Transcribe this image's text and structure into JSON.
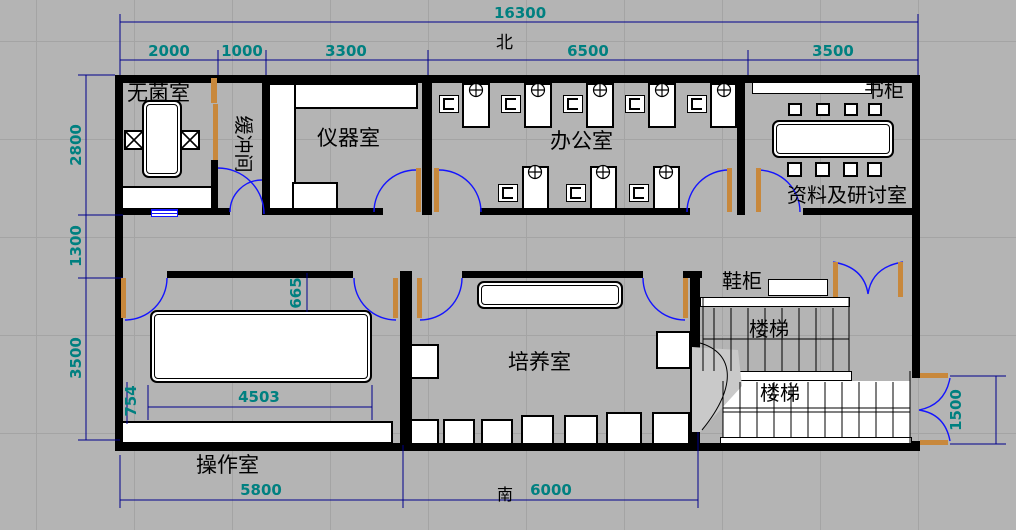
{
  "compass": {
    "north": "北",
    "south": "南"
  },
  "dims": {
    "total_top": "16300",
    "seg_2000": "2000",
    "seg_1000": "1000",
    "seg_3300": "3300",
    "seg_6500": "6500",
    "seg_3500": "3500",
    "left_2800": "2800",
    "left_1300": "1300",
    "left_3500": "3500",
    "bottom_5800": "5800",
    "bottom_6000": "6000",
    "right_1500": "1500",
    "op_table_width": "4503",
    "op_table_offset": "754",
    "op_door_offset": "665"
  },
  "rooms": {
    "sterile": "无菌室",
    "buffer": "缓冲间",
    "instrument": "仪器室",
    "office": "办公室",
    "bookcase": "书柜",
    "seminar": "资料及研讨室",
    "shoe": "鞋柜",
    "stair_upper": "楼梯",
    "stair_lower": "楼梯",
    "culture": "培养室",
    "operation": "操作室"
  },
  "colors": {
    "background": "#b4b4b4",
    "wall": "#000000",
    "dim_line": "#00008b",
    "dim_text": "#008080",
    "door_arc": "#1414ff",
    "door_leaf": "#c8883c",
    "furniture_fill": "#ffffff"
  }
}
